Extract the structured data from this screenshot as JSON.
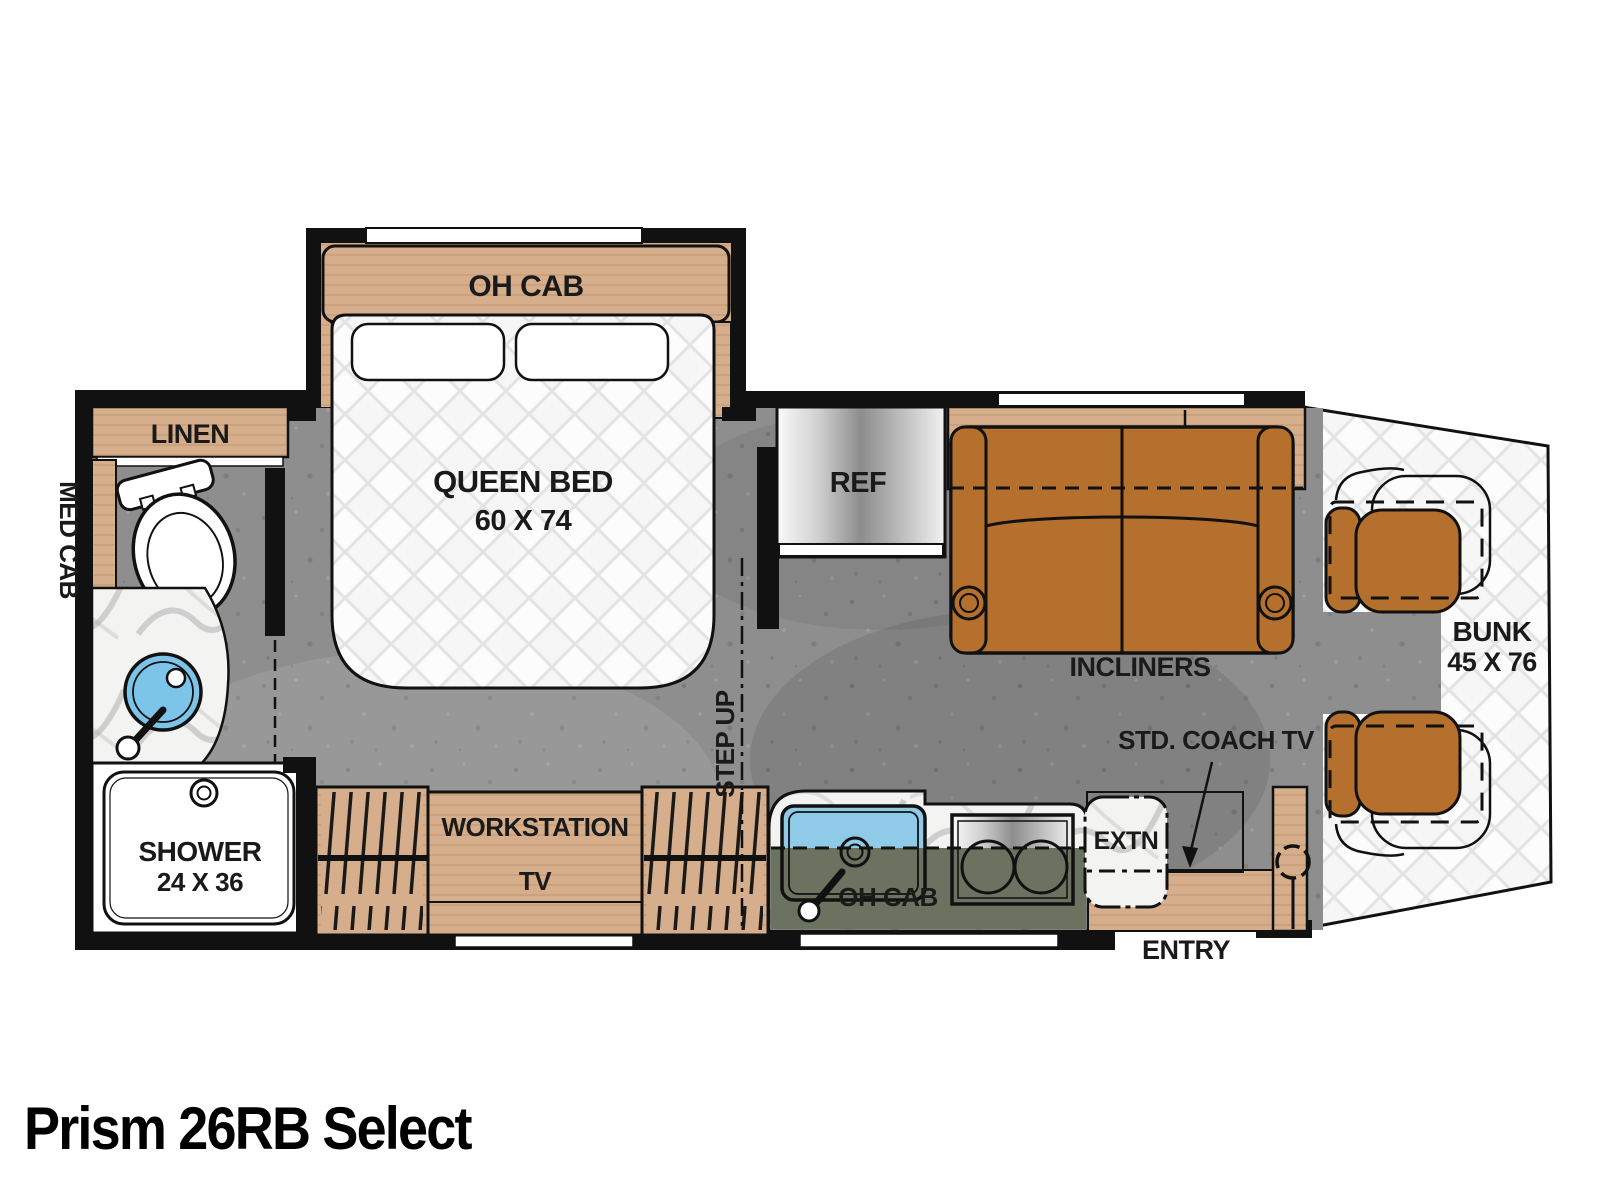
{
  "title": "Prism 26RB Select",
  "floorplan": {
    "bedroom": {
      "oh_cab": "OH CAB",
      "bed_label": "QUEEN BED",
      "bed_size": "60 X 74",
      "step_up": "STEP UP"
    },
    "bathroom": {
      "linen": "LINEN",
      "med_cab": "MED CAB",
      "shower": "SHOWER",
      "shower_size": "24 X 36"
    },
    "closet": {
      "workstation": "WORKSTATION",
      "tv": "TV"
    },
    "kitchen": {
      "ref": "REF",
      "oh_cab": "OH CAB",
      "extn": "EXTN"
    },
    "living": {
      "oh_cab": "OH CAB",
      "shelf": "SHELF",
      "incliners": "INCLINERS",
      "std_coach_tv": "STD. COACH TV"
    },
    "cab": {
      "bunk": "BUNK",
      "bunk_size": "45 X 76",
      "entry": "ENTRY"
    }
  },
  "colors": {
    "wall_black": "#111111",
    "wood_tan": "#d6ae8b",
    "sofa_brown": "#b4702c",
    "counter_olive": "#6b7260",
    "sink_blue": "#8fcae8",
    "bath_sink_blue": "#7cc5e8",
    "floor_gray": "#8e8e8e",
    "quilt_white": "#f6f6f6"
  }
}
